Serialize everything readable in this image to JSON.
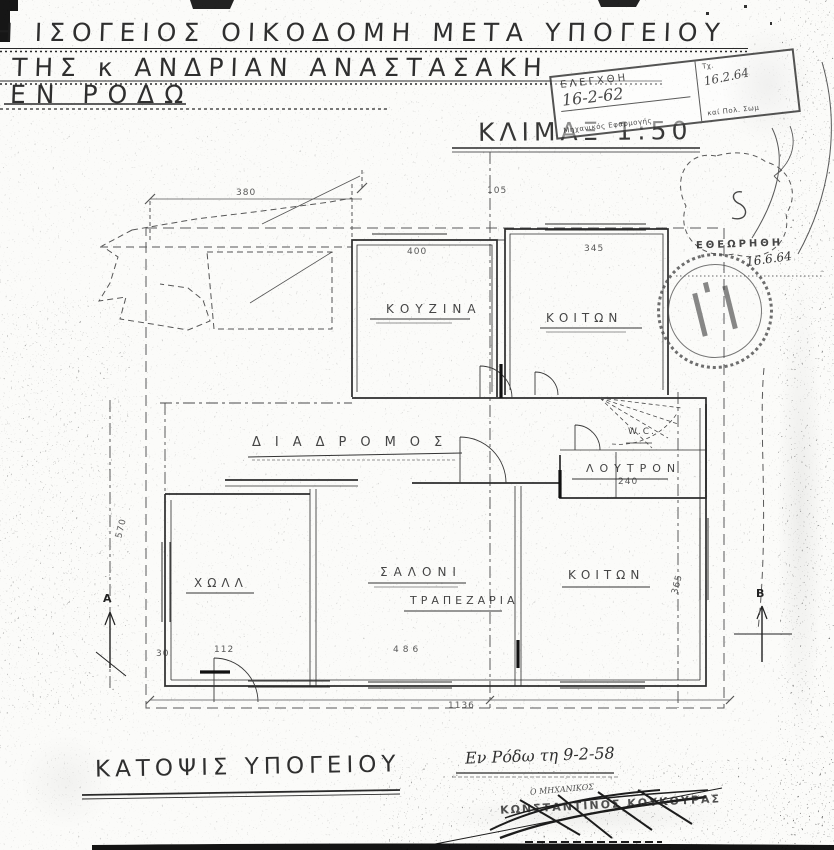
{
  "header": {
    "title_line1": "Η ΙΣΟΓΕΙΟΣ ΟΙΚΟΔΟΜΗ ΜΕΤΑ ΥΠΟΓΕΙΟΥ",
    "title_line2": "ΤΗΣ κ ΑΝΔΡΙΑΝ ΑΝΑΣΤΑΣΑΚΗ",
    "title_line3": "ΕΝ ΡΟΔΩ",
    "scale_label": "ΚΛΙΜΑΞ 1:50"
  },
  "plan": {
    "rooms": {
      "kitchen": "ΚΟΥΖΙΝΑ",
      "bedroom_top": "ΚΟΙΤΩΝ",
      "corridor": "ΔΙΑΔΡΟΜΟΣ",
      "wc": "W.C.",
      "bathroom": "ΛΟΥΤΡΟΝ",
      "hall": "ΧΩΛΛ",
      "living": "ΣΑΛΟΝΙ",
      "dining": "ΤΡΑΠΕΖΑΡΙΑ",
      "bedroom_bottom": "ΚΟΙΤΩΝ"
    },
    "dimensions": {
      "site_top": "380",
      "top_mid": "105",
      "kitchen_top": "400",
      "bedroom_top": "345",
      "bathroom": "240",
      "left_vertical": "570",
      "right_vertical": "365",
      "dining_bottom": "486",
      "porch_small": "30",
      "porch": "112",
      "bottom_total": "1136"
    },
    "section_markers": {
      "left": "A",
      "right": "B"
    }
  },
  "footer": {
    "drawing_title": "ΚΑΤΟΨΙΣ ΥΠΟΓΕΙΟΥ",
    "place_date": "Εν Ρόδω τη 9-2-58",
    "engineer_role": "Ο ΜΗΧΑΝΙΚΟΣ",
    "engineer_name": "ΚΩΝΣΤΑΝΤΙΝΟΣ ΚΟΥΚΟΥΡΑΣ"
  },
  "stamps": {
    "approval_box": {
      "line1": "ΕΛΕΓΧΘΗ",
      "note_left": "16-2-62",
      "caption": "Μηχανικός Εφαρμογής",
      "label_right": "Τχ.",
      "date_right": "16.2.64",
      "note_right": "καί Πολ. Σωμ"
    },
    "round": {
      "label": "ΕΘΕΩΡΗΘΗ",
      "date": "16.6.64"
    }
  }
}
